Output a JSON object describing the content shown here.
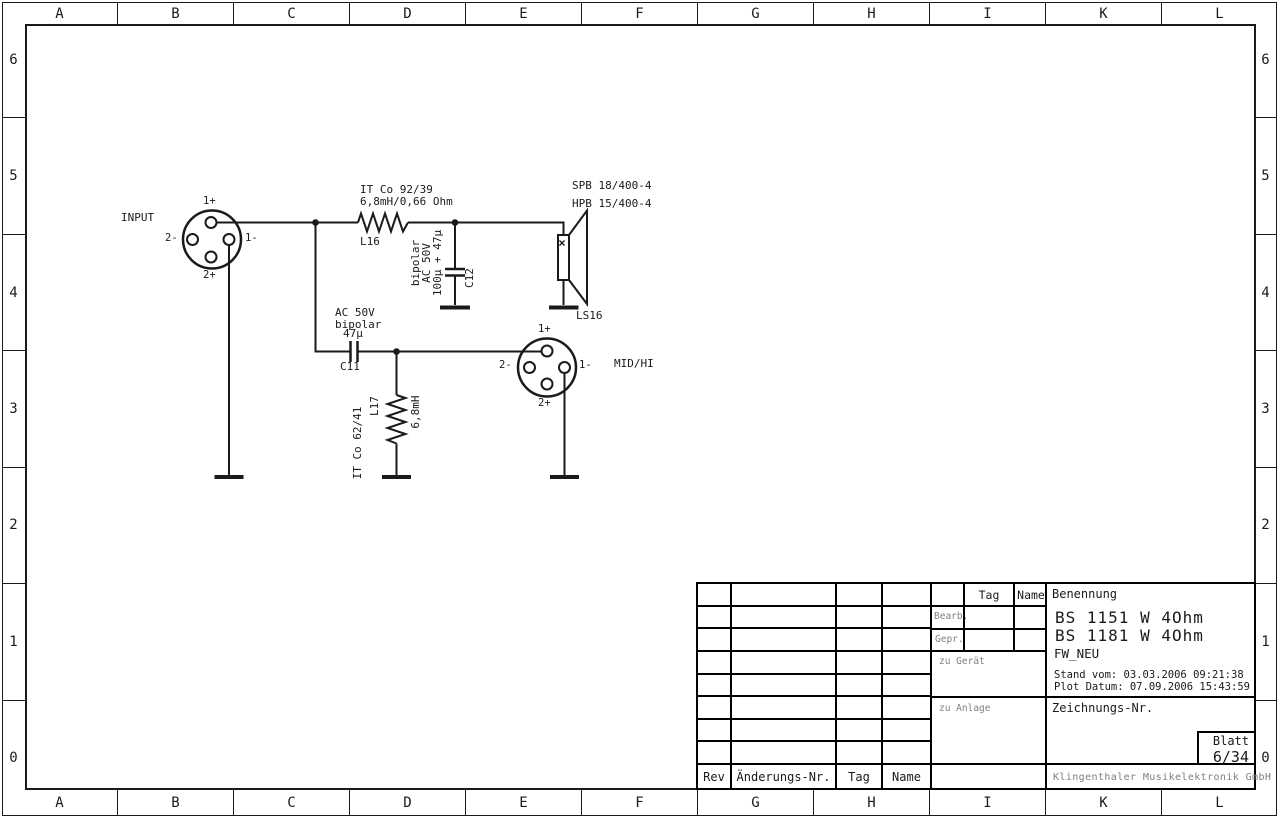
{
  "border": {
    "columns": [
      "A",
      "B",
      "C",
      "D",
      "E",
      "F",
      "G",
      "H",
      "I",
      "K",
      "L"
    ],
    "rows": [
      "6",
      "5",
      "4",
      "3",
      "2",
      "1",
      "0"
    ]
  },
  "circuit": {
    "input_connector": {
      "label": "INPUT",
      "pin_top": "1+",
      "pin_left": "2-",
      "pin_right": "1-",
      "pin_bottom": "2+"
    },
    "inductor_l16": {
      "type": "IT Co 92/39",
      "value": "6,8mH/0,66 Ohm",
      "ref": "L16"
    },
    "cap_c12": {
      "spec1": "bipolar",
      "spec2": "AC 50V",
      "spec3": "100µ + 47µ",
      "ref": "C12"
    },
    "speaker_ls16": {
      "model1": "SPB 18/400-4",
      "model2": "HPB 15/400-4",
      "ref": "LS16"
    },
    "cap_c11": {
      "spec1": "AC 50V",
      "spec2": "bipolar",
      "spec3": "47µ",
      "ref": "C11"
    },
    "inductor_l17": {
      "ref": "L17",
      "value": "6,8mH",
      "type": "IT Co 62/41"
    },
    "midhi_connector": {
      "label": "MID/HI",
      "pin_top": "1+",
      "pin_left": "2-",
      "pin_right": "1-",
      "pin_bottom": "2+"
    }
  },
  "title_block": {
    "rev_table": {
      "rev": "Rev",
      "change_nr": "Änderungs-Nr.",
      "tag": "Tag",
      "name": "Name"
    },
    "approval": {
      "tag": "Tag",
      "name": "Name",
      "bearb": "Bearb.",
      "gepr": "Gepr.",
      "zu_geraet": "zu Gerät",
      "zu_anlage": "zu Anlage"
    },
    "benennung_label": "Benennung",
    "title_line1": "BS 1151 W 4Ohm",
    "title_line2": "BS 1181 W 4Ohm",
    "subtitle": "FW_NEU",
    "stand_vom": "Stand vom: 03.03.2006 09:21:38",
    "plot_datum": "Plot Datum: 07.09.2006 15:43:59",
    "zeichnungs_label": "Zeichnungs-Nr.",
    "blatt_label": "Blatt",
    "blatt_value": "6/34",
    "company": "Klingenthaler Musikelektronik GmbH"
  }
}
